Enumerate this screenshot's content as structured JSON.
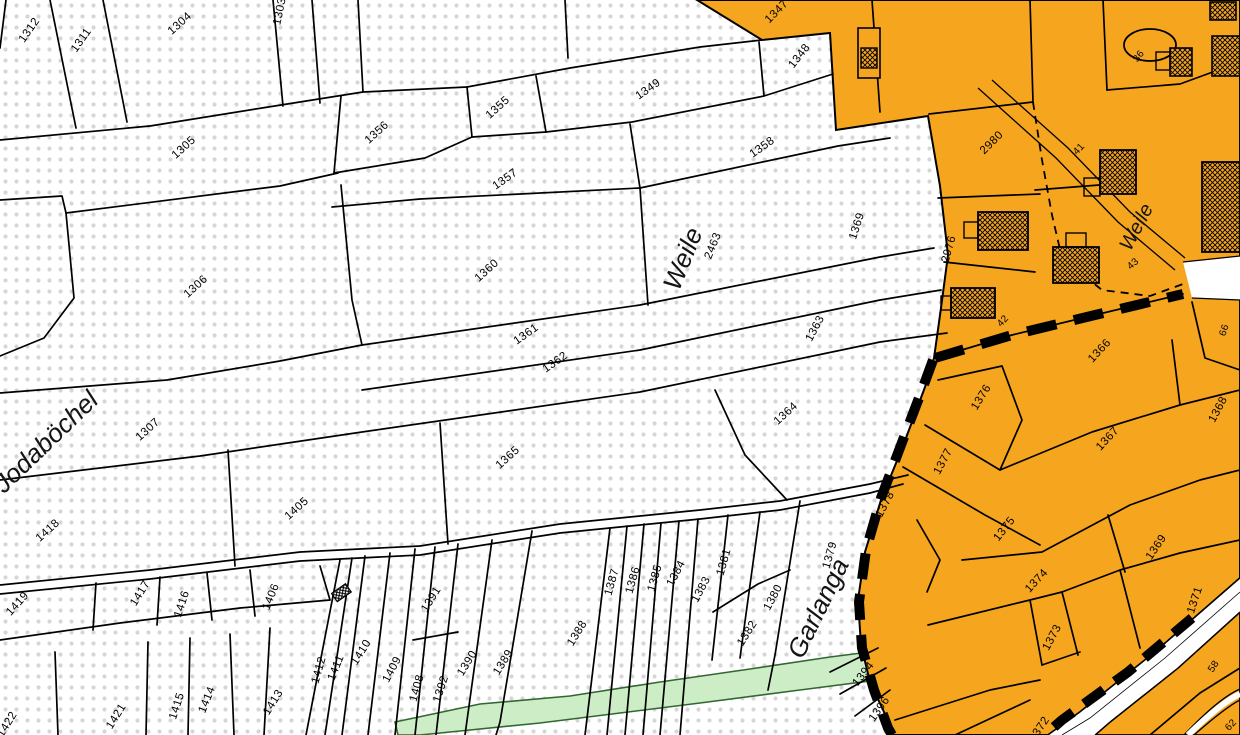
{
  "map": {
    "colors": {
      "builtup_orange": "#F6A51E",
      "green_fill": "#CDEDC6",
      "green_stroke": "#336633",
      "dot_gray": "#D6D6D6",
      "line_black": "#000000",
      "white": "#FFFFFF"
    },
    "labels": [
      {
        "t": "1312",
        "x": 32,
        "y": 32,
        "r": -55
      },
      {
        "t": "1311",
        "x": 84,
        "y": 42,
        "r": -55
      },
      {
        "t": "1304",
        "x": 182,
        "y": 26,
        "r": -42
      },
      {
        "t": "1303",
        "x": 283,
        "y": 12,
        "r": -78
      },
      {
        "t": "1305",
        "x": 186,
        "y": 150,
        "r": -42
      },
      {
        "t": "1306",
        "x": 198,
        "y": 289,
        "r": -42
      },
      {
        "t": "1356",
        "x": 379,
        "y": 135,
        "r": -42
      },
      {
        "t": "1355",
        "x": 500,
        "y": 110,
        "r": -42
      },
      {
        "t": "1357",
        "x": 507,
        "y": 182,
        "r": -35
      },
      {
        "t": "1349",
        "x": 650,
        "y": 92,
        "r": -35
      },
      {
        "t": "1348",
        "x": 802,
        "y": 58,
        "r": -52
      },
      {
        "t": "1347",
        "x": 779,
        "y": 14,
        "r": -45
      },
      {
        "t": "1358",
        "x": 764,
        "y": 150,
        "r": -35
      },
      {
        "t": "1360",
        "x": 489,
        "y": 273,
        "r": -42
      },
      {
        "t": "1361",
        "x": 528,
        "y": 337,
        "r": -35
      },
      {
        "t": "1362",
        "x": 557,
        "y": 365,
        "r": -35
      },
      {
        "t": "1363",
        "x": 818,
        "y": 330,
        "r": -62
      },
      {
        "t": "2463",
        "x": 716,
        "y": 247,
        "r": -68,
        "s": 11
      },
      {
        "t": "Weile",
        "x": 691,
        "y": 262,
        "r": -68,
        "k": "a",
        "s": 26
      },
      {
        "t": "1364",
        "x": 788,
        "y": 416,
        "r": -42
      },
      {
        "t": "1365",
        "x": 510,
        "y": 460,
        "r": -42
      },
      {
        "t": "1307",
        "x": 150,
        "y": 432,
        "r": -42
      },
      {
        "t": "Jodaböchel",
        "x": 52,
        "y": 448,
        "r": -44,
        "k": "a",
        "s": 27
      },
      {
        "t": "1369",
        "x": 860,
        "y": 227,
        "r": -72
      },
      {
        "t": "1418",
        "x": 50,
        "y": 533,
        "r": -42
      },
      {
        "t": "1405",
        "x": 299,
        "y": 511,
        "r": -42
      },
      {
        "t": "1419",
        "x": 20,
        "y": 606,
        "r": -48
      },
      {
        "t": "1417",
        "x": 143,
        "y": 595,
        "r": -58
      },
      {
        "t": "1416",
        "x": 185,
        "y": 605,
        "r": -72
      },
      {
        "t": "1406",
        "x": 274,
        "y": 598,
        "r": -68
      },
      {
        "t": "1421",
        "x": 119,
        "y": 718,
        "r": -58
      },
      {
        "t": "1422",
        "x": 10,
        "y": 726,
        "r": -58
      },
      {
        "t": "1415",
        "x": 180,
        "y": 707,
        "r": -72
      },
      {
        "t": "1414",
        "x": 210,
        "y": 701,
        "r": -68
      },
      {
        "t": "1413",
        "x": 276,
        "y": 704,
        "r": -58
      },
      {
        "t": "1412",
        "x": 322,
        "y": 671,
        "r": -74
      },
      {
        "t": "1411",
        "x": 339,
        "y": 669,
        "r": -68
      },
      {
        "t": "1410",
        "x": 364,
        "y": 654,
        "r": -58
      },
      {
        "t": "1409",
        "x": 395,
        "y": 671,
        "r": -62
      },
      {
        "t": "1408",
        "x": 420,
        "y": 689,
        "r": -74
      },
      {
        "t": "1391",
        "x": 434,
        "y": 601,
        "r": -58
      },
      {
        "t": "1392",
        "x": 444,
        "y": 690,
        "r": -72
      },
      {
        "t": "1390",
        "x": 470,
        "y": 665,
        "r": -58
      },
      {
        "t": "1389",
        "x": 506,
        "y": 664,
        "r": -58
      },
      {
        "t": "1388",
        "x": 580,
        "y": 635,
        "r": -58
      },
      {
        "t": "1387",
        "x": 615,
        "y": 583,
        "r": -74
      },
      {
        "t": "1386",
        "x": 636,
        "y": 581,
        "r": -74
      },
      {
        "t": "1385",
        "x": 658,
        "y": 579,
        "r": -74
      },
      {
        "t": "1384",
        "x": 679,
        "y": 575,
        "r": -62
      },
      {
        "t": "1383",
        "x": 704,
        "y": 591,
        "r": -62
      },
      {
        "t": "1381",
        "x": 727,
        "y": 563,
        "r": -74
      },
      {
        "t": "1380",
        "x": 776,
        "y": 599,
        "r": -62
      },
      {
        "t": "1382",
        "x": 750,
        "y": 635,
        "r": -58
      },
      {
        "t": "1379",
        "x": 833,
        "y": 556,
        "r": -74
      },
      {
        "t": "Garlanga",
        "x": 826,
        "y": 612,
        "r": -64,
        "k": "a",
        "s": 24
      },
      {
        "t": "1394",
        "x": 866,
        "y": 676,
        "r": -52
      },
      {
        "t": "1396",
        "x": 882,
        "y": 711,
        "r": -55
      },
      {
        "t": "2980",
        "x": 994,
        "y": 145,
        "r": -45
      },
      {
        "t": "2976",
        "x": 952,
        "y": 250,
        "r": -74
      },
      {
        "t": "36",
        "x": 1141,
        "y": 58,
        "r": -52,
        "k": "h"
      },
      {
        "t": "41",
        "x": 1081,
        "y": 151,
        "r": -47,
        "k": "h"
      },
      {
        "t": "42",
        "x": 1005,
        "y": 323,
        "r": -47,
        "k": "h"
      },
      {
        "t": "43",
        "x": 1135,
        "y": 266,
        "r": -42,
        "k": "h"
      },
      {
        "t": "Weile",
        "x": 1142,
        "y": 230,
        "r": -62,
        "k": "st",
        "s": 21
      },
      {
        "t": "1366",
        "x": 1102,
        "y": 353,
        "r": -47
      },
      {
        "t": "66",
        "x": 1227,
        "y": 331,
        "r": -72,
        "k": "h"
      },
      {
        "t": "1376",
        "x": 984,
        "y": 399,
        "r": -58
      },
      {
        "t": "1377",
        "x": 946,
        "y": 463,
        "r": -62
      },
      {
        "t": "1378",
        "x": 888,
        "y": 506,
        "r": -62
      },
      {
        "t": "1367",
        "x": 1110,
        "y": 441,
        "r": -47
      },
      {
        "t": "1368",
        "x": 1221,
        "y": 411,
        "r": -62
      },
      {
        "t": "1375",
        "x": 1007,
        "y": 531,
        "r": -52
      },
      {
        "t": "1374",
        "x": 1039,
        "y": 583,
        "r": -47
      },
      {
        "t": "1369",
        "x": 1159,
        "y": 549,
        "r": -56
      },
      {
        "t": "1373",
        "x": 1055,
        "y": 639,
        "r": -62
      },
      {
        "t": "1371",
        "x": 1198,
        "y": 601,
        "r": -72
      },
      {
        "t": "1372",
        "x": 1042,
        "y": 731,
        "r": -56
      },
      {
        "t": "58",
        "x": 1216,
        "y": 668,
        "r": -56,
        "k": "h",
        "s": 11
      },
      {
        "t": "62",
        "x": 1233,
        "y": 727,
        "r": -47,
        "k": "h"
      }
    ]
  }
}
